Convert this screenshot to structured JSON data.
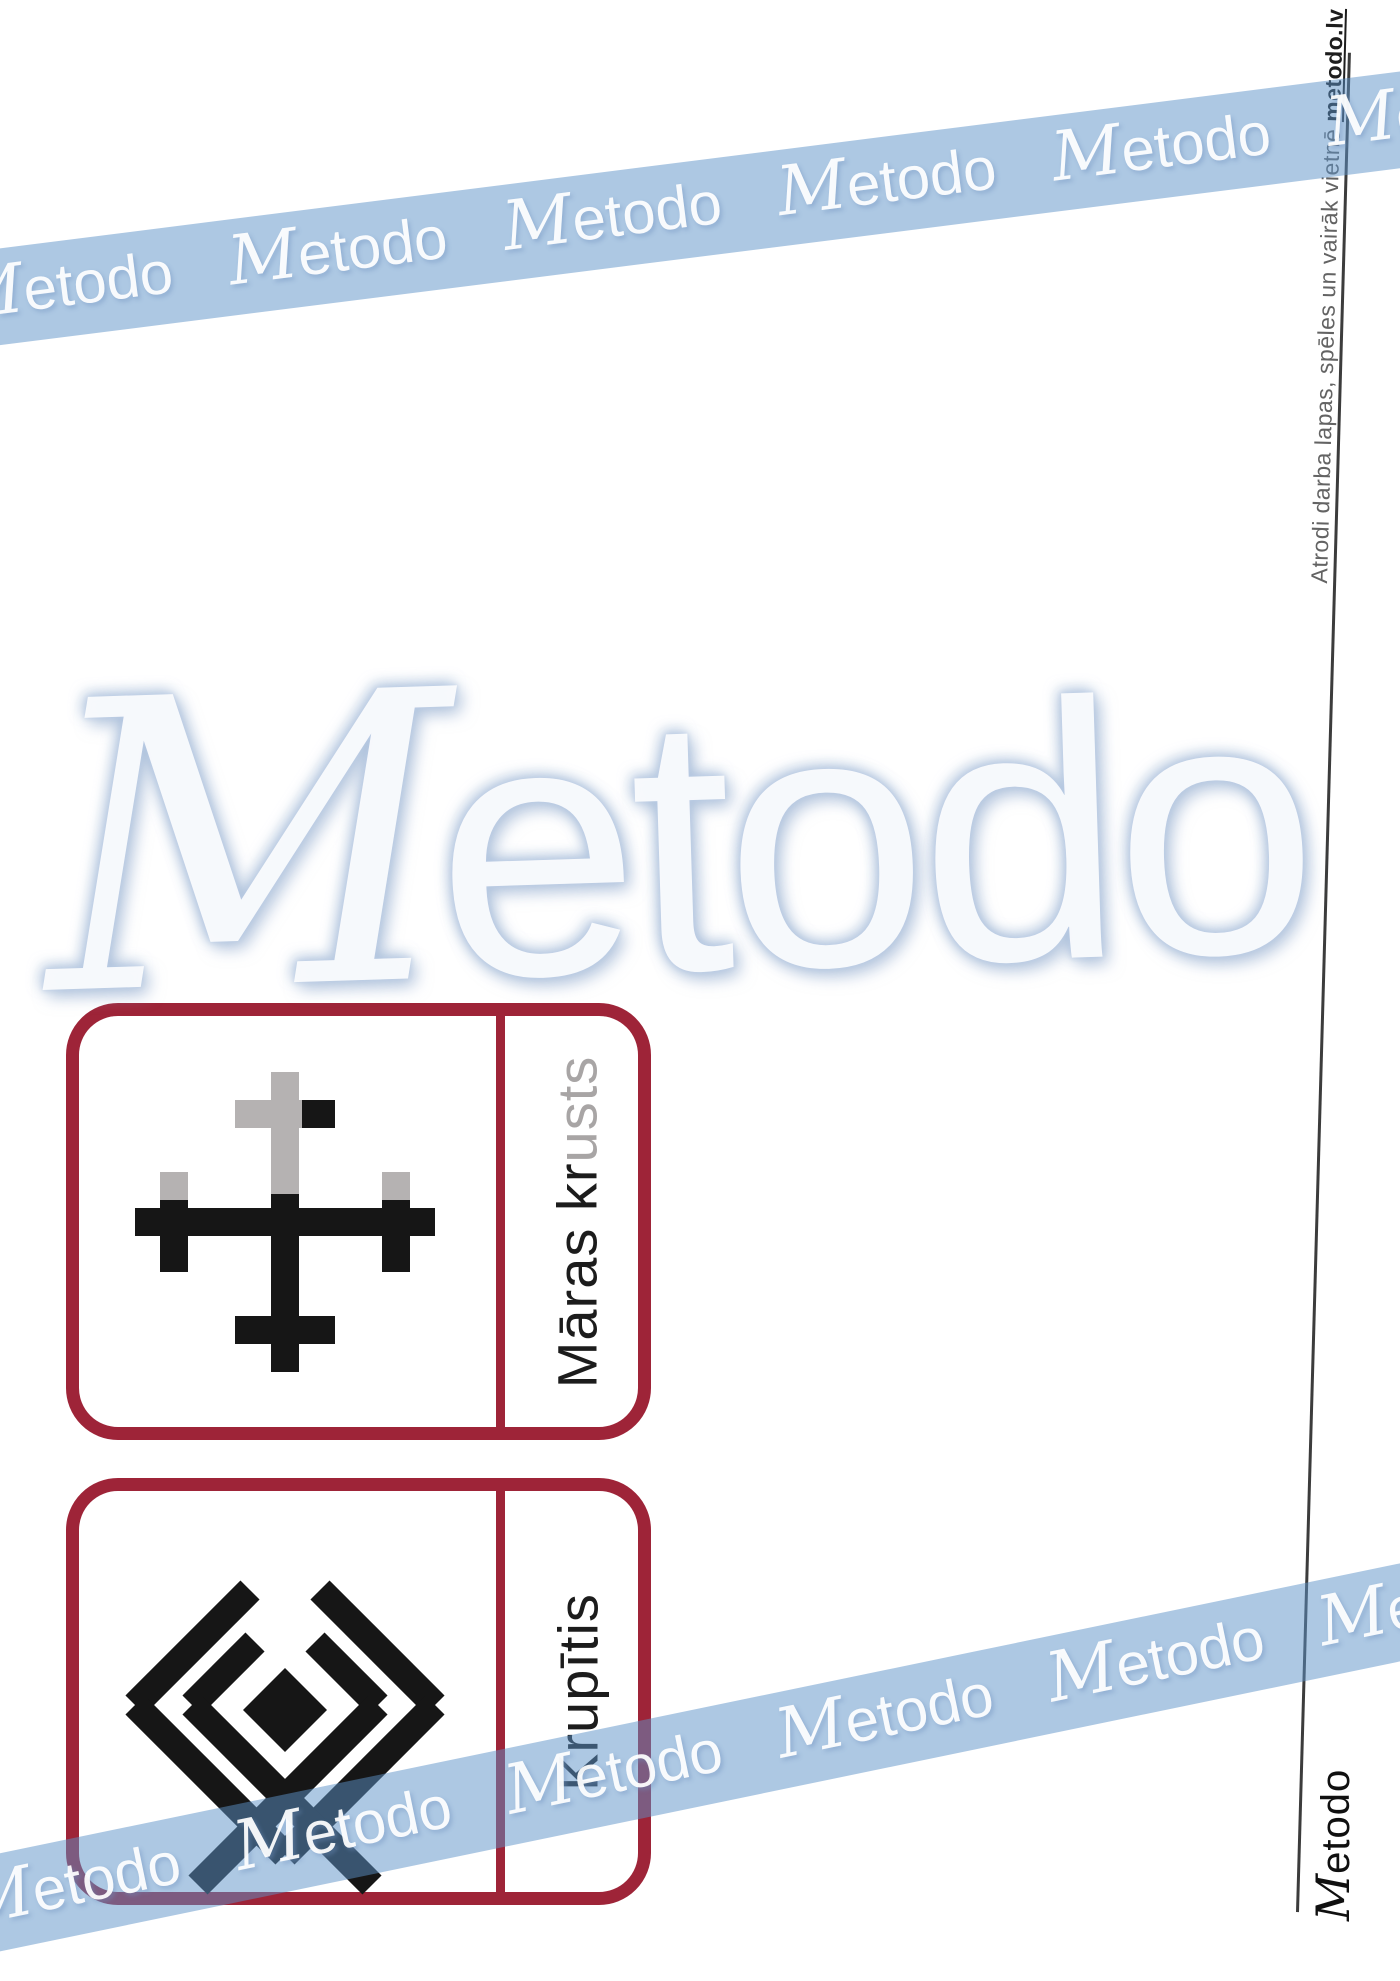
{
  "brand": "Metodo",
  "watermark": {
    "band_repeats": 6,
    "band_color": "rgba(92,145,200,0.5)",
    "glow_color": "#b8cde8"
  },
  "cards": [
    {
      "label": "Māras krusts",
      "symbol": "maras-krusts",
      "faded_tail_chars": 4
    },
    {
      "label": "Krupītis",
      "symbol": "krupitis",
      "faded_tail_chars": 0
    }
  ],
  "card_border_color": "#9e2438",
  "symbol_color": "#161616",
  "symbol_shadow_color": "#b5b2b2",
  "margin_note": {
    "text": "Atrodi darba lapas, spēles un vairāk vietnē ",
    "link": "metodo.lv"
  },
  "footer_logo": "Metodo"
}
